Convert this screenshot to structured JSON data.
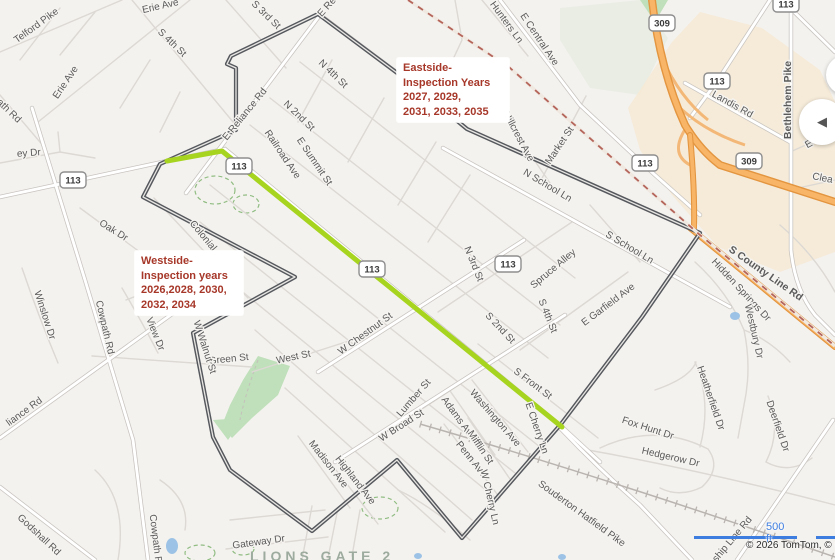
{
  "map": {
    "street_labels": [
      "Telford Pike",
      "Erie Ave",
      "S 3rd St",
      "S 4th St",
      "Erie Ave",
      "ath Rd",
      "E Re",
      "E Reliance Rd",
      "N 4th St",
      "N 2nd St",
      "Railroad Ave",
      "E Summit St",
      "Hunters Ln",
      "E Central Ave",
      "Hillcrest Ave",
      "Market St",
      "N School Ln",
      "S School Ln",
      "N 3rd St",
      "Spruce Alley",
      "S 4th St",
      "S 2nd St",
      "E Garfield Ave",
      "S Front St",
      "W Chestnut St",
      "Lumber St",
      "W Broad St",
      "Adams Ave",
      "Mifflin St",
      "Washington Ave",
      "Madison Ave",
      "Highland Ave",
      "Penn Ave",
      "W Cherry Ln",
      "E Cherry Ln",
      "Souderton Hatfield Pike",
      "Fox Hunt Dr",
      "Hedgerow Dr",
      "Heatherfield Dr",
      "Deerfield Dr",
      "Township Line Rd",
      "S County Line Rd",
      "Hidden Springs Dr",
      "Westbury Dr",
      "Landis Rd",
      "Bethlehem Pike",
      "E Ch",
      "Clea",
      "Oak Dr",
      "Colonial Ave",
      "ey Dr",
      "Winslow Dr",
      "Cowpath Rd",
      "Sky View Dr",
      "liance Rd",
      "Godshall Rd",
      "Cowpath Rd",
      "Gateway Dr",
      "Green St",
      "West St",
      "W Walnut St"
    ],
    "route_shields": [
      "113",
      "113",
      "113",
      "113",
      "113",
      "113",
      "113",
      "309",
      "309"
    ]
  },
  "annotations": {
    "eastside": {
      "lines": [
        "Eastside-",
        "Inspection Years",
        "2027, 2029,",
        "2031, 2033, 2035"
      ],
      "color": "#a63729"
    },
    "westside": {
      "lines": [
        "Westside-",
        "Inspection years",
        "2026,2028, 2030,",
        "2032, 2034"
      ],
      "color": "#a63729"
    }
  },
  "place_labels": {
    "lions_gate": "LIONS GATE 2"
  },
  "scale_bar": {
    "distance": "500 ft",
    "color": "#3d7de0"
  },
  "attribution": {
    "text": "© 2026 TomTom, © Open"
  },
  "controls": {
    "collapse_arrow": "◀"
  },
  "colors": {
    "route_highlight": "#a6d41f",
    "municipal_boundary": "#55585d",
    "county_line_dash": "#b5645a",
    "highway_orange": "#f8b568",
    "annotation_red": "#a63729",
    "scale_blue": "#3d7de0"
  }
}
